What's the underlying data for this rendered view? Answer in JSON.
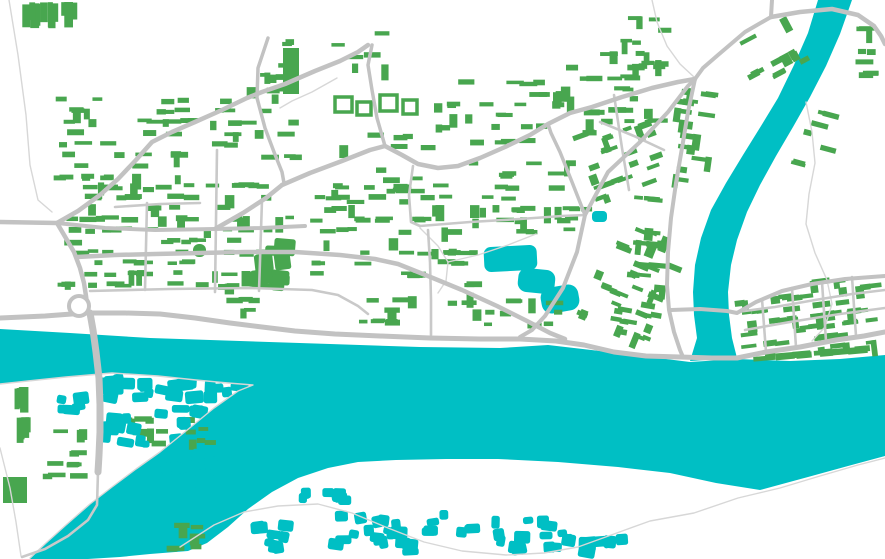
{
  "map": {
    "kind": "vector-city-map",
    "canvas": {
      "width": 885,
      "height": 559
    },
    "colors": {
      "background": "#ffffff",
      "water": "#00bfc4",
      "building_green": "#48a64f",
      "building_teal": "#00bfc4",
      "road_major": "#c2c2c2",
      "road_minor": "#c9c9c9",
      "road_thin": "#d7d7d7"
    },
    "water": {
      "river_path": "M0,329 L70,333 150,338 240,341 330,344 420,347 500,348 548,345 600,351 650,357 690,362 L737,359 790,361 840,359 885,355 L885,456 L848,466 808,477 760,490 L716,483 670,473 618,467 558,462 498,459 446,459 396,460 358,462 328,468 298,478 272,492 248,509 228,527 207,543 188,551 L150,554 120,557 88,559 L30,559 L46,543 66,525 90,504 112,487 136,469 160,452 186,431 214,408 238,391 253,385 L228,383 196,380 158,376 112,373 66,377 28,381 0,384 Z",
      "tributary_path": "M818,0 L852,0 L840,34 826,66 810,97 793,127 776,156 760,185 747,212 737,240 731,265 728,292 729,315 732,338 737,358 L690,361 L697,338 694,315 693,292 695,265 701,238 711,210 726,183 743,155 761,126 778,98 794,65 808,33 Z",
      "lakes": [
        {
          "x": 484,
          "y": 246,
          "w": 53,
          "h": 25,
          "rx": 7,
          "rot": -3
        },
        {
          "x": 518,
          "y": 269,
          "w": 37,
          "h": 24,
          "rx": 9,
          "rot": 6
        },
        {
          "x": 541,
          "y": 286,
          "w": 38,
          "h": 26,
          "rx": 10,
          "rot": -10
        },
        {
          "x": 592,
          "y": 211,
          "w": 15,
          "h": 11,
          "rx": 4,
          "rot": 0
        }
      ]
    },
    "roads": {
      "major": [
        {
          "d": "M0,318 L45,316 85,313 125,313 160,314 195,318 230,323 262,327 295,331 335,334 380,336 430,338 480,339 520,339 556,341 584,345 614,352 646,356 680,357 712,358 737,358 766,352 800,347 836,340 864,336 885,332",
          "w": 5
        },
        {
          "d": "M0,222 L57,223",
          "w": 4.5
        },
        {
          "d": "M57,223 L67,240 74,252 80,268 84,283 86,296 87,304",
          "w": 4.5
        },
        {
          "d": "M90,313 L93,330 96,352 99,378 100,405 100,432 99,455 98,472",
          "w": 7
        },
        {
          "d": "M77,257 L115,255 155,254 200,253 245,252 295,252 340,255 375,259 398,264 428,276 462,290 497,306 527,321 550,333 565,339",
          "w": 4.5
        },
        {
          "d": "M57,223 L105,228 155,230 215,229 262,228 305,226",
          "w": 4
        },
        {
          "d": "M215,229 L243,213 266,198 282,185",
          "w": 4.5
        },
        {
          "d": "M282,185 L310,173 342,161 370,150 385,146 402,155 418,164 438,168 458,166 480,158 505,147 530,135 548,124 570,113 592,107 622,97 652,88 678,82 695,79",
          "w": 4.5
        },
        {
          "d": "M385,146 L377,118 372,90 368,65 372,45",
          "w": 3.5
        },
        {
          "d": "M57,223 L78,211 100,195 118,179 136,160 152,142 172,132 195,122 222,110 247,98 262,92 285,84 315,71 340,61 358,52 368,45",
          "w": 4.5
        },
        {
          "d": "M268,38 L258,68 257,98 265,128 274,152 282,172 284,183",
          "w": 3.5
        },
        {
          "d": "M585,215 L572,182 560,152 551,133 548,124",
          "w": 3.5
        },
        {
          "d": "M585,215 L608,172 640,142 668,112 688,86 695,79",
          "w": 4
        },
        {
          "d": "M585,215 L577,252 563,288 545,316 532,330 520,337",
          "w": 4
        },
        {
          "d": "M695,79 L688,112 682,148 676,183 671,218 668,252 667,285 669,310 674,332 680,350 683,357",
          "w": 4
        },
        {
          "d": "M772,0 L771,17 745,32 718,55 703,68 695,79",
          "w": 4
        },
        {
          "d": "M771,17 L800,12 832,9 858,15 874,26 881,36 885,44",
          "w": 4.5
        },
        {
          "d": "M671,310 L700,309 727,311 737,313 756,302 782,291 812,284 845,279 885,276",
          "w": 4
        }
      ],
      "minor": [
        {
          "d": "M147,203 L145,290"
        },
        {
          "d": "M217,150 L215,292"
        },
        {
          "d": "M262,200 L259,291"
        },
        {
          "d": "M90,291 L170,289 250,288 312,290 338,295 358,306 368,314"
        },
        {
          "d": "M115,207 L160,204 200,203"
        },
        {
          "d": "M420,226 L470,222 520,219 562,216 585,215"
        },
        {
          "d": "M413,166 L409,195 411,222 420,226"
        },
        {
          "d": "M428,230 L430,262 431,300 431,335"
        },
        {
          "d": "M600,122 L634,136 664,150"
        },
        {
          "d": "M614,95 L622,148 629,190"
        },
        {
          "d": "M737,312 L775,307 815,300 852,294 885,290"
        },
        {
          "d": "M745,330 L790,322 840,314 885,308"
        },
        {
          "d": "M762,299 L766,352"
        },
        {
          "d": "M792,288 L796,347"
        },
        {
          "d": "M822,282 L826,341"
        },
        {
          "d": "M852,277 L856,336"
        },
        {
          "d": "M98,472 L97,505 88,520 68,536 45,549 22,557"
        }
      ],
      "thin": [
        {
          "d": "M0,384 L28,381 66,377 112,373 158,376 196,380 228,383 253,385 238,391 214,408 186,431 160,452 136,469 112,487 90,504 66,525 46,543 30,558"
        },
        {
          "d": "M0,448 L10,488 16,522 21,556"
        },
        {
          "d": "M180,547 L214,525 244,512 278,506 318,504 352,513 388,528 424,542 462,551 506,555 544,553 578,547 614,534 650,521 694,513 738,498 780,488 820,476 858,465 885,458"
        },
        {
          "d": "M806,102 L812,132 815,163 809,194 806,224 815,253 827,280 832,304 825,327 812,341"
        },
        {
          "d": "M652,0 L657,22 667,46 680,64 694,77"
        },
        {
          "d": "M9,0 L18,55 26,115 30,165 38,200 52,212"
        },
        {
          "d": "M420,228 L438,246 448,262 446,281 438,293"
        },
        {
          "d": "M448,262 L478,255 508,245 536,234"
        },
        {
          "d": "M337,78 L312,92 292,101 280,108"
        }
      ],
      "roundabout": {
        "cx": 79,
        "cy": 306,
        "r": 10,
        "w": 4
      }
    },
    "building_clusters": [
      {
        "x": 52,
        "y": 96,
        "w": 152,
        "h": 98,
        "n": 46,
        "color": "g",
        "style": "bars"
      },
      {
        "x": 208,
        "y": 86,
        "w": 96,
        "h": 78,
        "n": 20,
        "color": "g",
        "style": "bars"
      },
      {
        "x": 12,
        "y": 2,
        "w": 68,
        "h": 44,
        "n": 11,
        "color": "g",
        "style": "tallbars"
      },
      {
        "x": 258,
        "y": 28,
        "w": 45,
        "h": 75,
        "n": 8,
        "color": "g",
        "style": "bars"
      },
      {
        "x": 318,
        "y": 132,
        "w": 118,
        "h": 78,
        "n": 16,
        "color": "g",
        "style": "bars"
      },
      {
        "x": 328,
        "y": 30,
        "w": 64,
        "h": 44,
        "n": 6,
        "color": "g",
        "style": "bars"
      },
      {
        "x": 432,
        "y": 68,
        "w": 138,
        "h": 66,
        "n": 24,
        "color": "g",
        "style": "bars"
      },
      {
        "x": 556,
        "y": 52,
        "w": 118,
        "h": 90,
        "n": 28,
        "color": "g",
        "style": "bars"
      },
      {
        "x": 608,
        "y": 16,
        "w": 78,
        "h": 56,
        "n": 12,
        "color": "g",
        "style": "bars"
      },
      {
        "x": 738,
        "y": 26,
        "w": 68,
        "h": 50,
        "n": 12,
        "color": "g",
        "style": "bars",
        "rot": -28
      },
      {
        "x": 852,
        "y": 26,
        "w": 32,
        "h": 82,
        "n": 9,
        "color": "g",
        "style": "bars"
      },
      {
        "x": 796,
        "y": 110,
        "w": 55,
        "h": 62,
        "n": 7,
        "color": "g",
        "style": "bars",
        "rot": 15
      },
      {
        "x": 668,
        "y": 88,
        "w": 48,
        "h": 95,
        "n": 22,
        "color": "g",
        "style": "bars",
        "rot": 8
      },
      {
        "x": 582,
        "y": 118,
        "w": 86,
        "h": 78,
        "n": 26,
        "color": "g",
        "style": "bars",
        "rot": -20
      },
      {
        "x": 628,
        "y": 195,
        "w": 42,
        "h": 100,
        "n": 16,
        "color": "g",
        "style": "bars",
        "rot": 5
      },
      {
        "x": 42,
        "y": 182,
        "w": 258,
        "h": 112,
        "n": 100,
        "color": "g",
        "style": "bars"
      },
      {
        "x": 303,
        "y": 183,
        "w": 132,
        "h": 100,
        "n": 38,
        "color": "g",
        "style": "bars"
      },
      {
        "x": 230,
        "y": 236,
        "w": 68,
        "h": 56,
        "n": 9,
        "color": "g",
        "style": "blobs",
        "sz": [
          12,
          24,
          10,
          20
        ]
      },
      {
        "x": 428,
        "y": 183,
        "w": 165,
        "h": 58,
        "n": 32,
        "color": "g",
        "style": "bars"
      },
      {
        "x": 425,
        "y": 248,
        "w": 58,
        "h": 62,
        "n": 12,
        "color": "g",
        "style": "bars"
      },
      {
        "x": 440,
        "y": 298,
        "w": 135,
        "h": 34,
        "n": 14,
        "color": "g",
        "style": "bars"
      },
      {
        "x": 468,
        "y": 138,
        "w": 112,
        "h": 46,
        "n": 12,
        "color": "g",
        "style": "bars"
      },
      {
        "x": 592,
        "y": 228,
        "w": 88,
        "h": 108,
        "n": 30,
        "color": "g",
        "style": "bars",
        "rot": 22
      },
      {
        "x": 606,
        "y": 298,
        "w": 62,
        "h": 42,
        "n": 9,
        "color": "g",
        "style": "bars",
        "rot": 10
      },
      {
        "x": 735,
        "y": 280,
        "w": 150,
        "h": 76,
        "n": 62,
        "color": "g",
        "style": "bars",
        "rot": -7
      },
      {
        "x": 735,
        "y": 350,
        "w": 150,
        "h": 16,
        "n": 11,
        "color": "g",
        "style": "bars",
        "sz": [
          12,
          24,
          4.5,
          7
        ],
        "rot": -5
      },
      {
        "x": 343,
        "y": 296,
        "w": 78,
        "h": 34,
        "n": 10,
        "color": "g",
        "style": "bars"
      },
      {
        "x": 205,
        "y": 295,
        "w": 70,
        "h": 26,
        "n": 6,
        "color": "g",
        "style": "bars"
      },
      {
        "x": 10,
        "y": 386,
        "w": 26,
        "h": 56,
        "n": 9,
        "color": "g",
        "style": "tallbars"
      },
      {
        "x": 42,
        "y": 428,
        "w": 46,
        "h": 52,
        "n": 12,
        "color": "g",
        "style": "bars"
      },
      {
        "x": 122,
        "y": 416,
        "w": 112,
        "h": 32,
        "n": 15,
        "color": "g",
        "style": "bars"
      },
      {
        "x": 166,
        "y": 522,
        "w": 40,
        "h": 28,
        "n": 8,
        "color": "g",
        "style": "bars"
      },
      {
        "x": 98,
        "y": 372,
        "w": 152,
        "h": 32,
        "n": 26,
        "color": "t",
        "style": "blobs",
        "sz": [
          9,
          20,
          8,
          13
        ]
      },
      {
        "x": 92,
        "y": 402,
        "w": 122,
        "h": 46,
        "n": 18,
        "color": "t",
        "style": "blobs"
      },
      {
        "x": 152,
        "y": 446,
        "w": 68,
        "h": 56,
        "n": 9,
        "color": "t",
        "style": "blobs",
        "sz": [
          11,
          20,
          10,
          16
        ]
      },
      {
        "x": 52,
        "y": 388,
        "w": 40,
        "h": 28,
        "n": 6,
        "color": "t",
        "style": "blobs"
      },
      {
        "x": 296,
        "y": 486,
        "w": 56,
        "h": 20,
        "n": 9,
        "color": "t",
        "style": "blobs",
        "sz": [
          8,
          14,
          7,
          11
        ]
      },
      {
        "x": 250,
        "y": 516,
        "w": 44,
        "h": 40,
        "n": 9,
        "color": "t",
        "style": "blobs"
      },
      {
        "x": 322,
        "y": 510,
        "w": 130,
        "h": 48,
        "n": 22,
        "color": "t",
        "style": "blobs"
      },
      {
        "x": 455,
        "y": 514,
        "w": 125,
        "h": 44,
        "n": 18,
        "color": "t",
        "style": "blobs"
      },
      {
        "x": 578,
        "y": 532,
        "w": 68,
        "h": 26,
        "n": 8,
        "color": "t",
        "style": "blobs"
      }
    ],
    "special_buildings": [
      {
        "x": 3,
        "y": 477,
        "w": 24,
        "h": 26,
        "color": "g",
        "rx": 0
      },
      {
        "x": 283,
        "y": 48,
        "w": 16,
        "h": 46,
        "color": "g",
        "rx": 0
      },
      {
        "x": 193,
        "y": 244,
        "w": 13,
        "h": 13,
        "color": "g",
        "rx": 6
      }
    ],
    "hollow_buildings": [
      {
        "x": 335,
        "y": 97,
        "w": 17,
        "h": 15
      },
      {
        "x": 357,
        "y": 102,
        "w": 14,
        "h": 13
      },
      {
        "x": 380,
        "y": 95,
        "w": 17,
        "h": 16
      },
      {
        "x": 403,
        "y": 100,
        "w": 14,
        "h": 14
      }
    ]
  }
}
